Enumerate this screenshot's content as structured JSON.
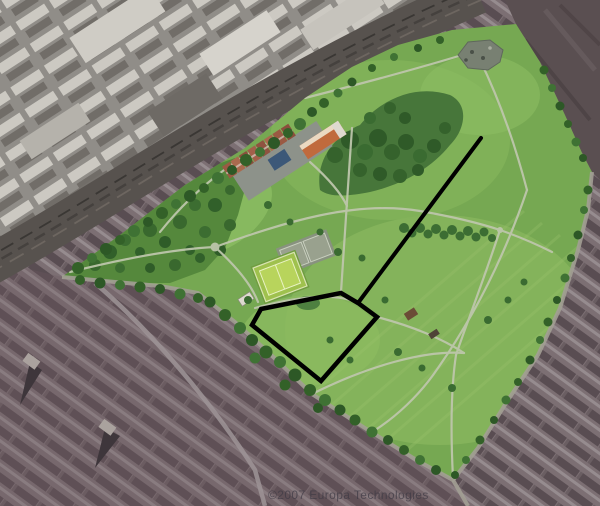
{
  "map": {
    "type": "satellite-aerial-photo",
    "subject": "Large urban park bounded by a railway corridor to the northwest and terraced housing to the south and east",
    "watermark": "©2007 Europa Technologies",
    "annotations": {
      "color": "#000000",
      "line_path": "M481,138 L358,303",
      "area_path": "M261,309 L341,293 L358,303 L377,317 L321,381 L252,325 Z"
    },
    "colors": {
      "park_green": "#76a852",
      "scrub_green": "#55883c",
      "tree_green": "#35622c",
      "path_light": "#bdc6ab",
      "railway_dark": "#57524e",
      "industrial_gray": "#908d88",
      "residential_mauve": "#7c6f73",
      "urban_dark_northeast": "#5a4f51",
      "pitch_bright": "#b8d45c",
      "annotation": "#000000"
    }
  }
}
